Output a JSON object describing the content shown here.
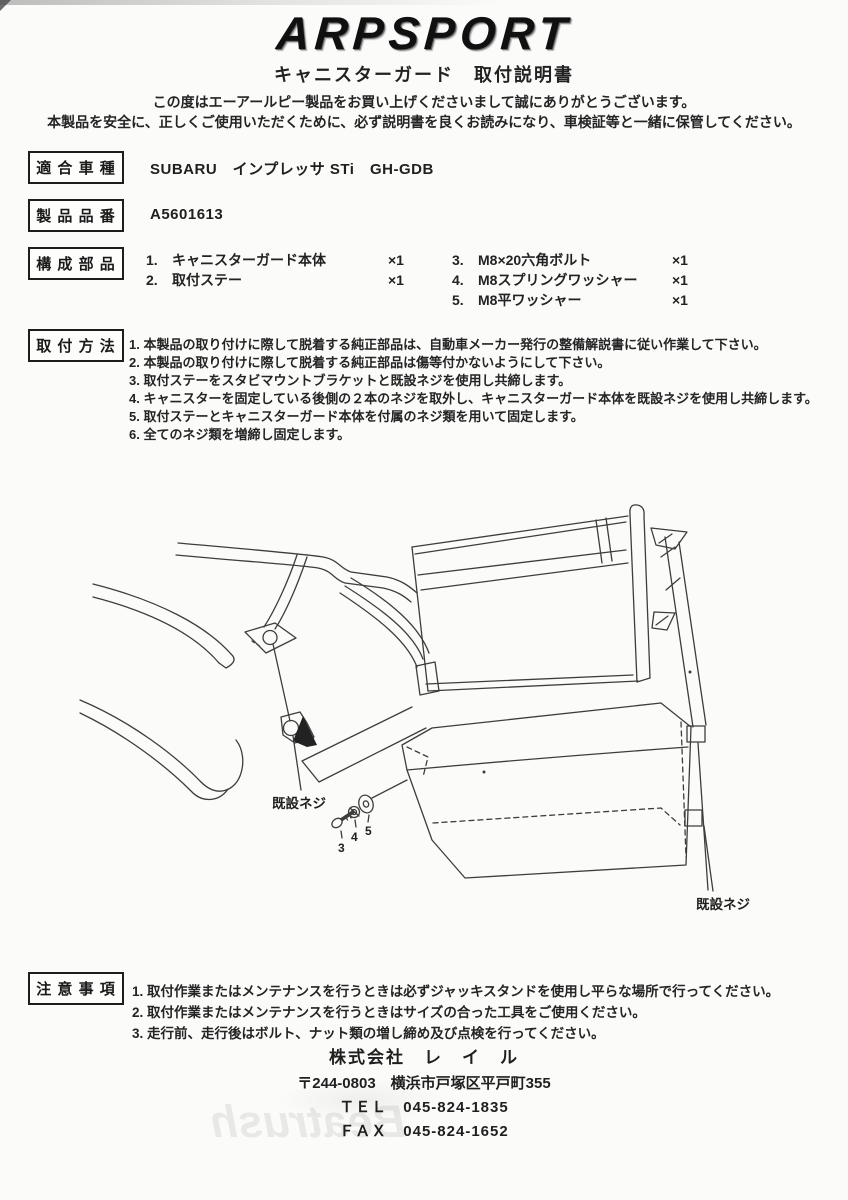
{
  "header": {
    "logo": "ARPSPORT",
    "doc_title": "キャニスターガード　取付説明書",
    "greeting_line1": "この度はエーアールピー製品をお買い上げくださいまして誠にありがとうございます。",
    "greeting_line2": "本製品を安全に、正しくご使用いただくために、必ず説明書を良くお読みになり、車検証等と一緒に保管してください。"
  },
  "sections": {
    "vehicle": {
      "label": "適 合 車 種",
      "value": "SUBARU　インプレッサ STi　GH-GDB"
    },
    "part_number": {
      "label": "製 品 品 番",
      "value": "A5601613"
    },
    "components": {
      "label": "構 成 部 品",
      "items_left": [
        {
          "no": "1.",
          "name": "キャニスターガード本体",
          "qty": "×1"
        },
        {
          "no": "2.",
          "name": "取付ステー",
          "qty": "×1"
        }
      ],
      "items_right": [
        {
          "no": "3.",
          "name": "M8×20六角ボルト",
          "qty": "×1"
        },
        {
          "no": "4.",
          "name": "M8スプリングワッシャー",
          "qty": "×1"
        },
        {
          "no": "5.",
          "name": "M8平ワッシャー",
          "qty": "×1"
        }
      ]
    },
    "installation": {
      "label": "取 付 方 法",
      "steps": [
        "1. 本製品の取り付けに際して脱着する純正部品は、自動車メーカー発行の整備解説書に従い作業して下さい。",
        "2. 本製品の取り付けに際して脱着する純正部品は傷等付かないようにして下さい。",
        "3. 取付ステーをスタビマウントブラケットと既設ネジを使用し共締します。",
        "4. キャニスターを固定している後側の２本のネジを取外し、キャニスターガード本体を既設ネジを使用し共締します。",
        "5. 取付ステーとキャニスターガード本体を付属のネジ類を用いて固定します。",
        "6. 全てのネジ類を増締し固定します。"
      ]
    },
    "cautions": {
      "label": "注 意 事 項",
      "items": [
        "1. 取付作業またはメンテナンスを行うときは必ずジャッキスタンドを使用し平らな場所で行ってください。",
        "2. 取付作業またはメンテナンスを行うときはサイズの合った工具をご使用ください。",
        "3. 走行前、走行後はボルト、ナット類の増し締め及び点検を行ってください。"
      ]
    }
  },
  "diagram": {
    "existing_screw_left": "既設ネジ",
    "existing_screw_right": "既設ネジ",
    "part_no_3": "3",
    "part_no_4": "4",
    "part_no_5": "5"
  },
  "footer": {
    "company": "株式会社　レ　イ　ル",
    "address": "〒244-0803　横浜市戸塚区平戸町355",
    "tel": "ＴＥＬ　045-824-1835",
    "fax": "ＦＡＸ　045-824-1652"
  },
  "watermark": {
    "bleed_through_text": "Beatrush"
  }
}
